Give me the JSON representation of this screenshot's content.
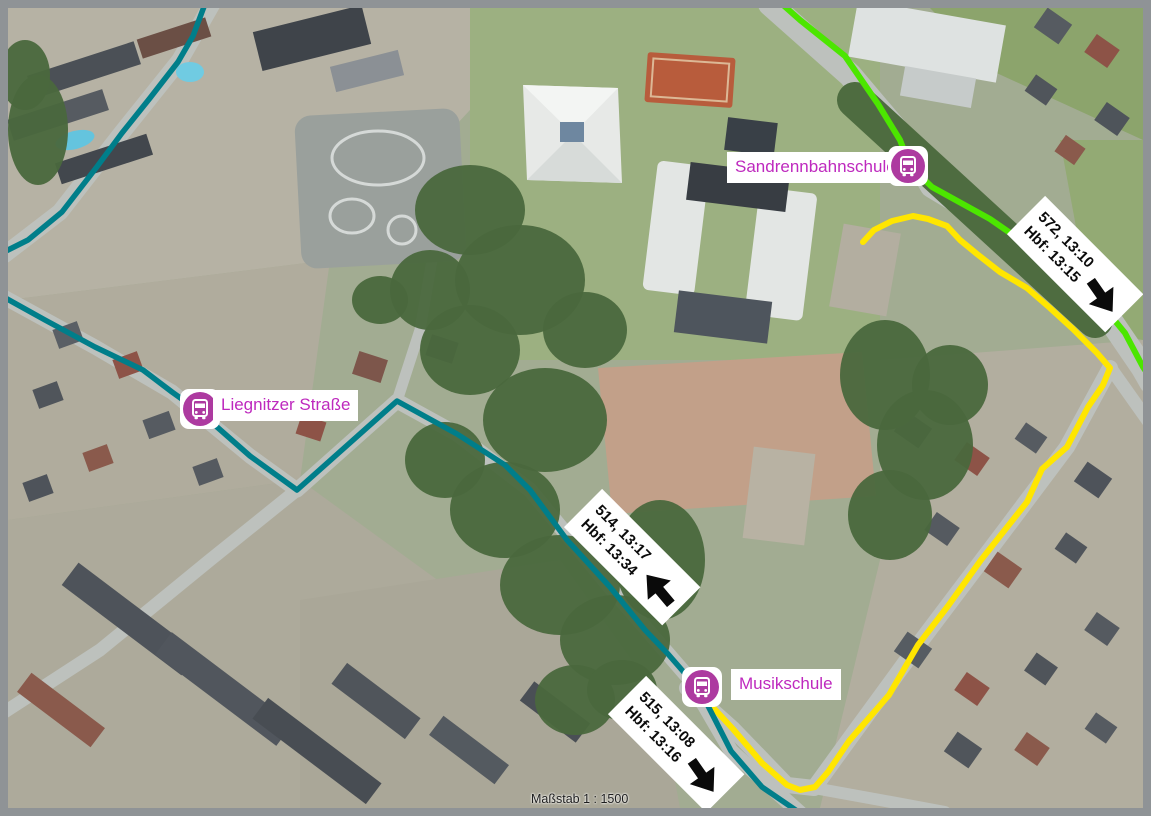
{
  "map": {
    "scale_label": "Maßstab 1 : 1500",
    "stops": [
      {
        "name": "Sandrennbahnschule",
        "icon": "bus"
      },
      {
        "name": "Liegnitzer Straße",
        "icon": "bus"
      },
      {
        "name": "Musikschule",
        "icon": "bus"
      }
    ],
    "departures": [
      {
        "line1": "572, 13:10",
        "line2": "Hbf: 13:15",
        "direction": "southeast"
      },
      {
        "line1": "514, 13:17",
        "line2": "Hbf: 13:34",
        "direction": "northwest"
      },
      {
        "line1": "515, 13:08",
        "line2": "Hbf: 13:16",
        "direction": "southeast"
      }
    ],
    "colors": {
      "route_green": "#4CE600",
      "route_yellow": "#FFE600",
      "route_teal": "#007E8A",
      "stop_icon": "#AD3AA0",
      "stop_label_text": "#BE29BE",
      "frame_border": "#8F9396"
    }
  }
}
